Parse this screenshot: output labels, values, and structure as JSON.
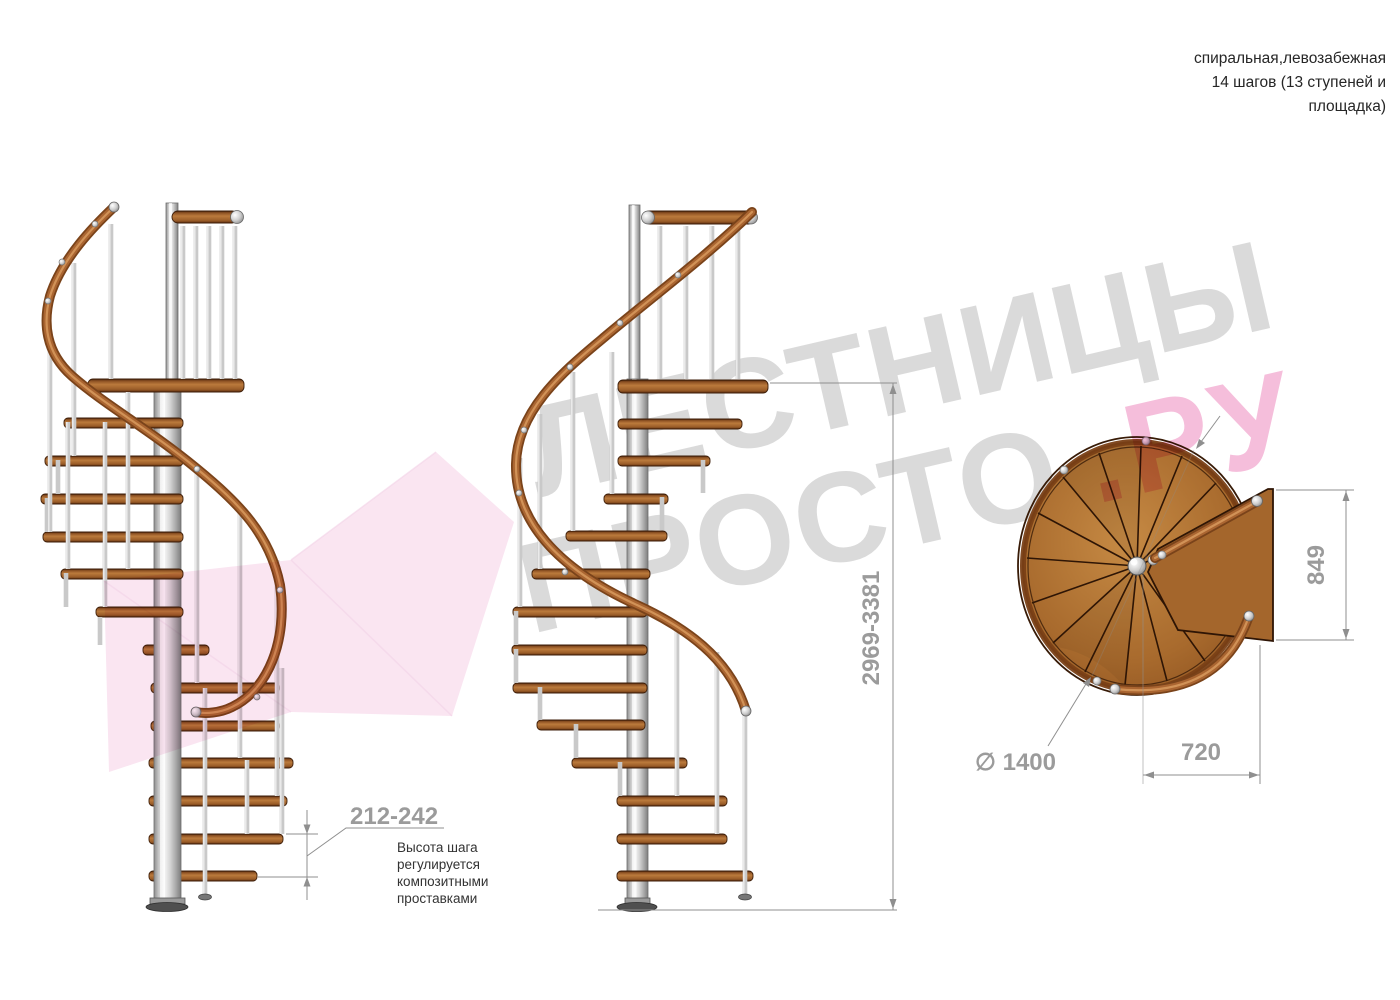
{
  "header": {
    "title_lines": [
      "спиральная,левозабежная",
      "14 шагов (13 ступеней и",
      "площадка)"
    ]
  },
  "watermark": {
    "brand_word_top": "ЛЕСТНИЦЫ",
    "brand_word_bottom": "ПРОСТО",
    "brand_suffix": ".РУ",
    "gray_color": "#d4d4d4",
    "pink_color": "#f3aed2",
    "arrow_color": "#f6cfe6"
  },
  "dimensions": {
    "step_height": {
      "value": "212-242",
      "note_lines": [
        "Высота шага",
        "регулируется",
        "композитными",
        "проставками"
      ]
    },
    "total_height": {
      "value": "2969-3381"
    },
    "landing_depth": {
      "value": "849"
    },
    "clear_width": {
      "value": "720"
    },
    "diameter": {
      "value": "∅ 1400"
    }
  },
  "colors": {
    "wood": "#b0712f",
    "handrail": "#aa6531",
    "steel": "#cfcfcf",
    "dim_text": "#9b9b9b",
    "dim_line": "#8f8f8f"
  }
}
